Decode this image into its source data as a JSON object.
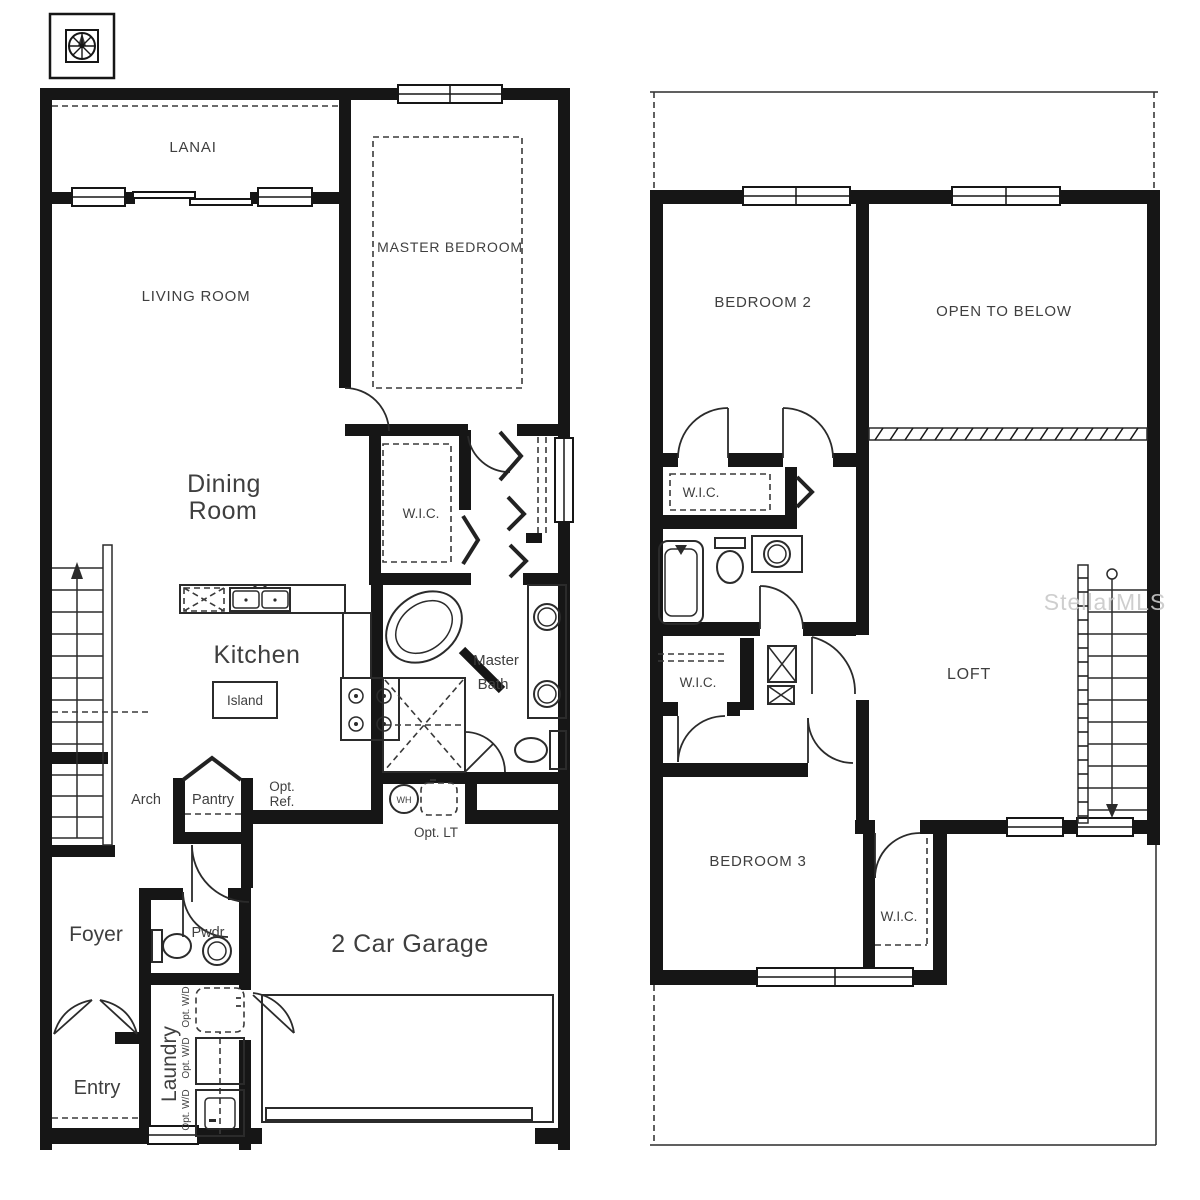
{
  "meta": {
    "type": "floor-plan",
    "colors": {
      "background": "#ffffff",
      "walls": "#161616",
      "text": "#3f3f3f",
      "watermark": "#c9c9c9"
    }
  },
  "watermark": {
    "text": "StellarMLS"
  },
  "floor1": {
    "labels": {
      "lanai": "LANAI",
      "living_room": "LIVING ROOM",
      "master_bedroom": "MASTER BEDROOM",
      "dining_line1": "Dining",
      "dining_line2": "Room",
      "wic": "W.I.C.",
      "kitchen": "Kitchen",
      "island": "Island",
      "master_bath_line1": "Master",
      "master_bath_line2": "Bath",
      "arch": "Arch",
      "pantry": "Pantry",
      "opt_ref_line1": "Opt.",
      "opt_ref_line2": "Ref.",
      "wh": "WH",
      "opt_lt": "Opt. LT",
      "foyer": "Foyer",
      "pwdr": "Pwdr",
      "garage": "2 Car Garage",
      "laundry": "Laundry",
      "entry": "Entry",
      "opt_wd_top": "Opt. W/D",
      "opt_wd_mid": "Opt. W/D",
      "opt_wd_bottom": "Opt. W/D"
    }
  },
  "floor2": {
    "labels": {
      "bedroom2": "BEDROOM 2",
      "open_to_below": "OPEN TO BELOW",
      "wic_upper": "W.I.C.",
      "loft": "LOFT",
      "wic_mid": "W.I.C.",
      "bedroom3": "BEDROOM 3",
      "wic_lower": "W.I.C."
    }
  }
}
